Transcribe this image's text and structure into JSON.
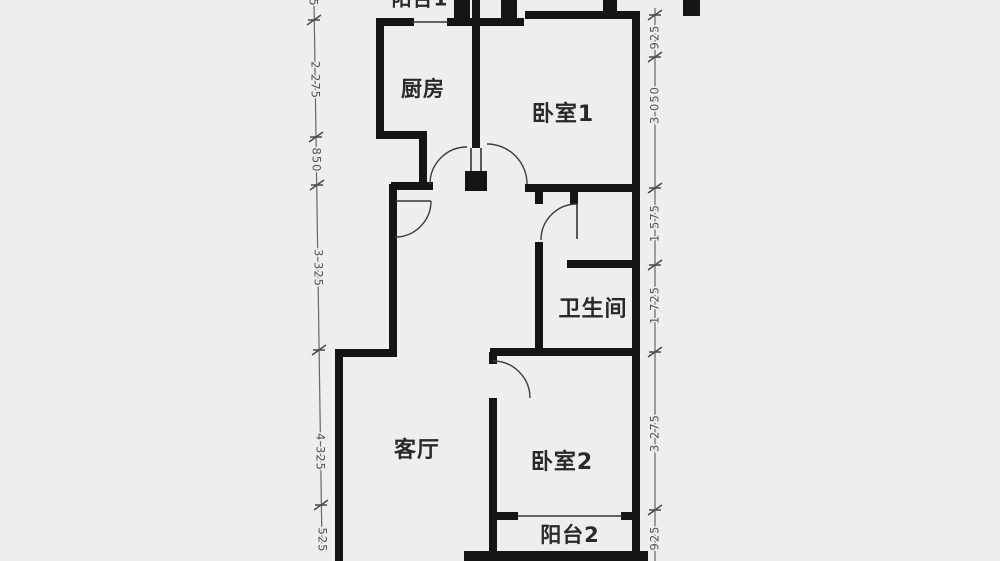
{
  "document": {
    "type": "apartment-floor-plan-scan",
    "orientation": "cropped at top and bottom edges"
  },
  "rooms": {
    "kitchen": {
      "label": "厨房"
    },
    "bedroom1": {
      "label": "卧室1"
    },
    "bathroom": {
      "label": "卫生间"
    },
    "living_room": {
      "label": "客厅"
    },
    "bedroom2": {
      "label": "卧室2"
    },
    "balcony2": {
      "label": "阳台2"
    },
    "balcony1": {
      "label": "阳台1"
    }
  },
  "dimensions": {
    "left": [
      "1 5",
      "2 275",
      "850",
      "3 325",
      "4 325",
      "525"
    ],
    "right": [
      "925",
      "3 050",
      "1 575",
      "1 725",
      "3 275",
      "925"
    ]
  },
  "colors": {
    "wall": "#151515",
    "thin_line": "#333333",
    "arc": "#3d3d3d",
    "dimension": "#4e5254",
    "room_label": "#27292a",
    "background": "#edefec"
  }
}
